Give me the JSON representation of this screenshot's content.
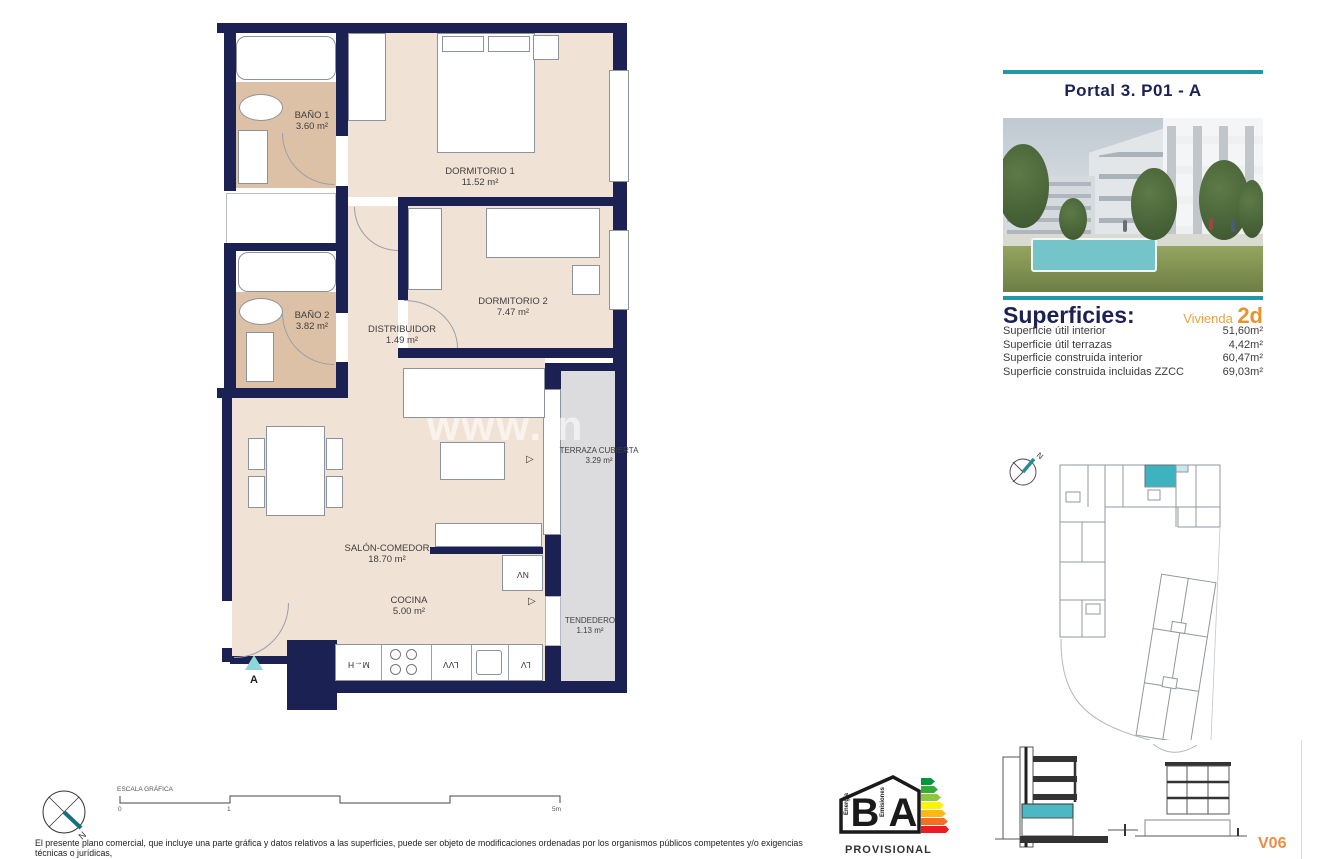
{
  "header": {
    "title": "Portal 3. P01 - A"
  },
  "superficies": {
    "title": "Superficies:",
    "unit_label": "Vivienda",
    "unit_code": "2d",
    "rows": [
      {
        "label": "Superficie útil interior",
        "value": "51,60m²"
      },
      {
        "label": "Superficie útil terrazas",
        "value": "4,42m²"
      },
      {
        "label": "Superficie construida interior",
        "value": "60,47m²"
      },
      {
        "label": "Superficie construida incluidas ZZCC",
        "value": "69,03m²"
      }
    ]
  },
  "floor_plan": {
    "watermark": "www.in",
    "entrance_label": "A",
    "rooms": [
      {
        "name": "BAÑO 1",
        "area": "3.60 m²"
      },
      {
        "name": "BAÑO 2",
        "area": "3.82 m²"
      },
      {
        "name": "DISTRIBUIDOR",
        "area": "1.49 m²"
      },
      {
        "name": "DORMITORIO 1",
        "area": "11.52 m²"
      },
      {
        "name": "DORMITORIO 2",
        "area": "7.47 m²"
      },
      {
        "name": "SALÓN-COMEDOR",
        "area": "18.70 m²"
      },
      {
        "name": "COCINA",
        "area": "5.00 m²"
      },
      {
        "name": "TERRAZA CUBIERTA",
        "area": "3.29 m²"
      },
      {
        "name": "TENDEDERO",
        "area": "1.13 m²"
      }
    ],
    "appliance_labels": {
      "oven_micro": "M←H",
      "dishwasher": "LVV",
      "washer": "LV",
      "fridge": "NV"
    },
    "slide_marker": "▷"
  },
  "scale_bar": {
    "label": "ESCALA GRÁFICA",
    "tick_start": "0",
    "tick_mid": "1",
    "tick_end": "5m"
  },
  "compass": {
    "north_label": "N"
  },
  "key_plan": {
    "north_label": "N"
  },
  "energy_logo": {
    "left_letter": "B",
    "right_letter": "A",
    "left_caption": "Energía",
    "right_caption": "Emisiones",
    "status": "PROVISIONAL"
  },
  "sections": {
    "version": "V06"
  },
  "disclaimer": {
    "line1": "El presente plano comercial, que incluye una parte gráfica y datos relativos a las superficies, puede ser objeto de modificaciones ordenadas por los organismos públicos competentes y/o exigencias técnicas o jurídicas,",
    "line2": "siempre y cuando estén justificados y no supongan alteraciones sustanciales. El mobiliario mostrado no está incluido y el equipamiento del inmueble será el indicado en la correspondiente memoria de calidades."
  },
  "colors": {
    "teal": "#2198a8",
    "navy": "#1b2153",
    "orange": "#e8942c",
    "highlight": "#45b5c2"
  }
}
